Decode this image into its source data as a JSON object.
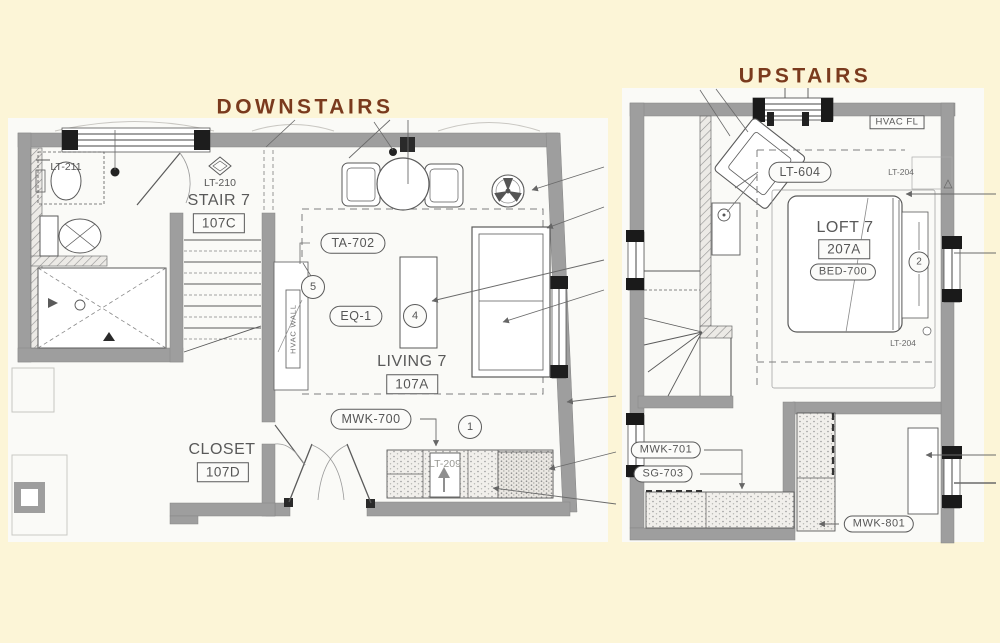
{
  "colors": {
    "background": "#FCF5D7",
    "paper": "#FAFAF7",
    "title_text": "#7A3A1D",
    "wall_gray": "#9E9E9E",
    "line_dark": "#555555"
  },
  "titles": {
    "downstairs": "DOWNSTAIRS",
    "upstairs": "UPSTAIRS"
  },
  "downstairs": {
    "bath_fixture_tag": "LT-211",
    "stair_light_tag": "LT-210",
    "stair_room": {
      "name": "STAIR 7",
      "number": "107C"
    },
    "living_room": {
      "name": "LIVING 7",
      "number": "107A"
    },
    "closet_room": {
      "name": "CLOSET",
      "number": "107D"
    },
    "table_tag": "TA-702",
    "equipment_tag": "EQ-1",
    "millwork_tag": "MWK-700",
    "kitchen_light_tag": "LT-209",
    "hvac_wall_label": "HVAC WALL",
    "keynotes": {
      "one": "1",
      "four": "4",
      "five": "5"
    }
  },
  "upstairs": {
    "hvac_label": "HVAC FL",
    "loft_light_tag": "LT-604",
    "window_tag_top": "LT-204",
    "window_tag_bottom": "LT-204",
    "loft_room": {
      "name": "LOFT 7",
      "number": "207A"
    },
    "bed_tag": "BED-700",
    "millwork_tag_1": "MWK-701",
    "glass_tag": "SG-703",
    "millwork_tag_2": "MWK-801",
    "keynotes": {
      "two": "2"
    }
  }
}
